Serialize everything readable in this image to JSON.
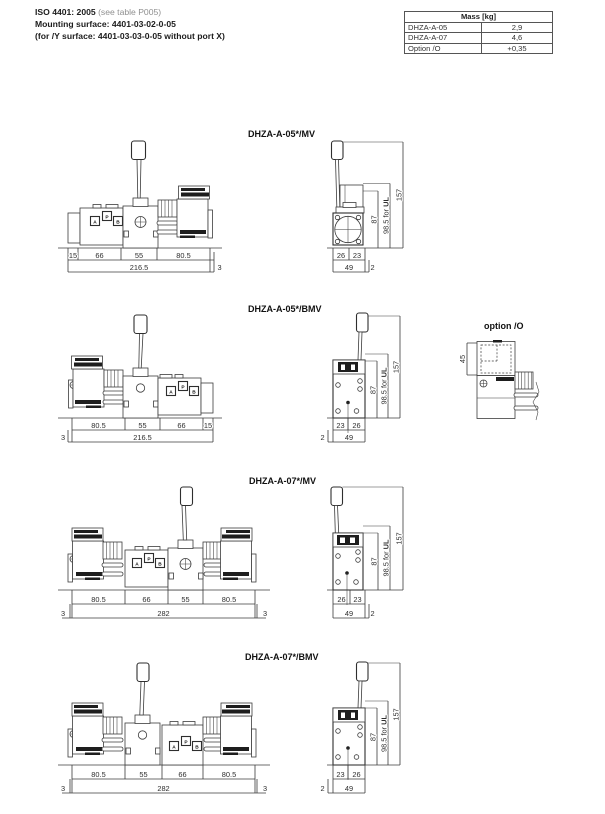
{
  "header": {
    "iso_bold": "ISO 4401: 2005",
    "iso_note": " (see table P005)",
    "line2": "Mounting surface: 4401-03-02-0-05",
    "line3": "(for /Y surface: 4401-03-03-0-05 without port X)"
  },
  "mass_table": {
    "title": "Mass [kg]",
    "rows": [
      [
        "DHZA-A-05",
        "2,9"
      ],
      [
        "DHZA-A-07",
        "4,6"
      ],
      [
        "Option /O",
        "+0,35"
      ]
    ]
  },
  "ports": {
    "a": "A",
    "p": "P",
    "b": "B"
  },
  "side_common": {
    "h87": "87",
    "h985_prefix": "98.5 for ",
    "h985_bold": "UL",
    "h157": "157",
    "w49": "49",
    "off2": "2"
  },
  "drawings": [
    {
      "title": "DHZA-A-05*/MV",
      "dims": [
        "15",
        "66",
        "55",
        "80.5"
      ],
      "total": "216.5",
      "extra_right": "3",
      "side": [
        "26",
        "23"
      ]
    },
    {
      "title": "DHZA-A-05*/BMV",
      "dims": [
        "80.5",
        "55",
        "66",
        "15"
      ],
      "total": "216.5",
      "extra_left": "3",
      "side": [
        "23",
        "26"
      ]
    },
    {
      "title": "DHZA-A-07*/MV",
      "dims": [
        "80.5",
        "66",
        "55",
        "80.5"
      ],
      "total": "282",
      "extra_left": "3",
      "extra_right": "3",
      "side": [
        "26",
        "23"
      ]
    },
    {
      "title": "DHZA-A-07*/BMV",
      "dims": [
        "80.5",
        "55",
        "66",
        "80.5"
      ],
      "total": "282",
      "extra_left": "3",
      "extra_right": "3",
      "side": [
        "23",
        "26"
      ]
    }
  ],
  "option_detail": {
    "title": "option /O",
    "dim": "45"
  }
}
